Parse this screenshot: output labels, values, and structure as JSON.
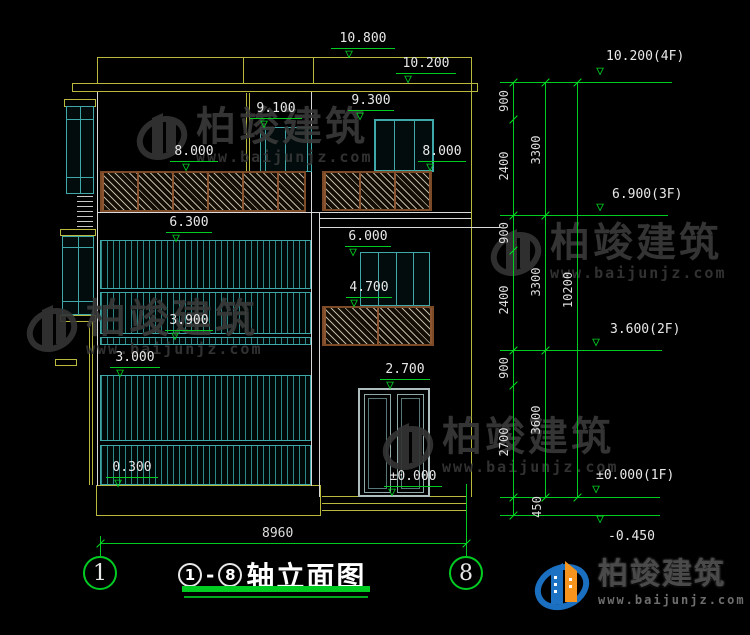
{
  "drawing": {
    "facade_levels": [
      "10.800",
      "10.200",
      "9.300",
      "9.100",
      "8.000",
      "8.000",
      "6.300",
      "6.000",
      "4.700",
      "3.900",
      "3.000",
      "2.700",
      "0.300",
      "±0.000"
    ],
    "floor_levels": [
      "10.200(4F)",
      "6.900(3F)",
      "3.600(2F)",
      "±0.000(1F)",
      "-0.450"
    ],
    "dim_inner": [
      "900",
      "2400",
      "900",
      "2400",
      "900",
      "2700",
      "450"
    ],
    "dim_mid": [
      "3300",
      "3300",
      "3600"
    ],
    "dim_total": "10200",
    "dim_width": "8960",
    "axis_bubbles": [
      "1",
      "8"
    ],
    "title": {
      "start": "1",
      "separator": "-",
      "end": "8",
      "text": "轴立面图"
    }
  },
  "watermark": {
    "brand": "柏竣建筑",
    "url": "www.baijunjz.com"
  },
  "logo": {
    "brand": "柏竣建筑",
    "url": "www.baijunjz.com"
  },
  "colors": {
    "dim_green": "#00cc22",
    "cad_yellow": "#b9b93e",
    "window_teal": "#3fa8a8",
    "rail_brown": "#7c4a26",
    "logo_blue": "#1b6fc0",
    "logo_orange": "#f7941d"
  }
}
